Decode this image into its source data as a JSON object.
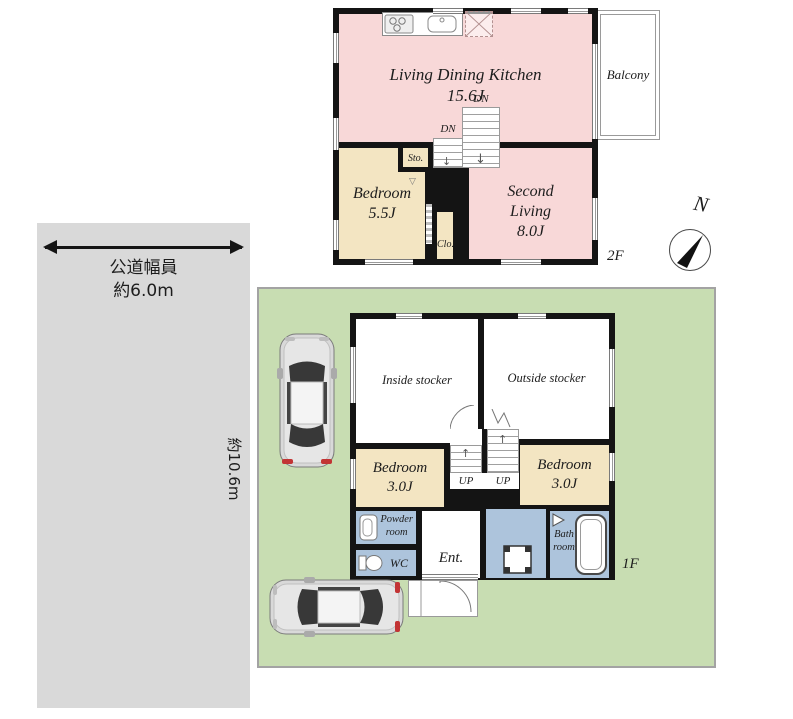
{
  "site": {
    "road_width_label_line1": "公道幅員",
    "road_width_label_line2": "約6.0m",
    "lot_depth_label": "約10.6m",
    "compass_north_label": "N"
  },
  "floor2": {
    "floor_label": "2F",
    "ldk_name": "Living Dining Kitchen",
    "ldk_size": "15.6J",
    "balcony_label": "Balcony",
    "bedroom_name": "Bedroom",
    "bedroom_size": "5.5J",
    "storage_label": "Sto.",
    "closet_label": "Clo.",
    "second_living_name_line1": "Second",
    "second_living_name_line2": "Living",
    "second_living_size": "8.0J",
    "stairs_down_label_1": "DN",
    "stairs_down_label_2": "DN"
  },
  "floor1": {
    "floor_label": "1F",
    "inside_stocker_label": "Inside stocker",
    "outside_stocker_label": "Outside stocker",
    "bedroom_left_name": "Bedroom",
    "bedroom_left_size": "3.0J",
    "bedroom_right_name": "Bedroom",
    "bedroom_right_size": "3.0J",
    "stairs_up_label_1": "UP",
    "stairs_up_label_2": "UP",
    "powder_room_line1": "Powder",
    "powder_room_line2": "room",
    "wc_label": "WC",
    "entrance_label": "Ent.",
    "bath_room_line1": "Bath",
    "bath_room_line2": "room"
  },
  "icons": {
    "down_arrow": "↓",
    "up_arrow": "↑",
    "door_swing_marker": "▽"
  },
  "colors": {
    "room_pink": "#f8d8d8",
    "room_beige": "#f3e5c2",
    "room_blue": "#adc4dc",
    "lot_green": "#c8ddb2",
    "road_gray": "#d9d9d9",
    "wall_black": "#141414"
  }
}
